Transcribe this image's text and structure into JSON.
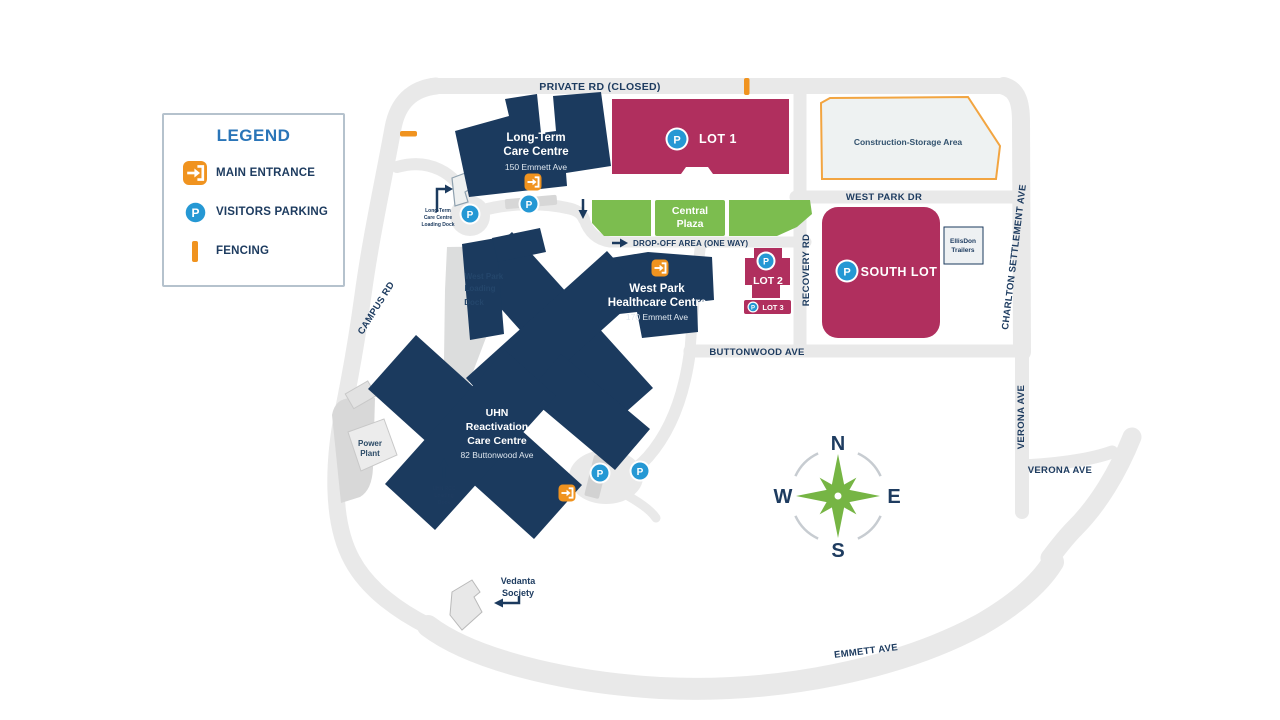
{
  "legend": {
    "title": "LEGEND",
    "items": [
      {
        "label": "MAIN ENTRANCE"
      },
      {
        "label": "VISITORS PARKING"
      },
      {
        "label": "FENCING"
      }
    ]
  },
  "icons": {
    "parking_letter": "P"
  },
  "compass": {
    "n": "N",
    "e": "E",
    "s": "S",
    "w": "W"
  },
  "roads": {
    "private_rd": "PRIVATE RD (CLOSED)",
    "campus_rd": "CAMPUS RD",
    "west_park_dr": "WEST PARK DR",
    "recovery_rd": "RECOVERY RD",
    "buttonwood_ave": "BUTTONWOOD AVE",
    "charlton_settlement_ave": "CHARLTON SETTLEMENT AVE",
    "verona_ave_vertical": "VERONA AVE",
    "verona_ave_horizontal": "VERONA AVE",
    "emmett_ave": "EMMETT AVE",
    "drop_off": "DROP-OFF  AREA (ONE WAY)"
  },
  "parking_lots": {
    "lot1": "LOT 1",
    "lot2": "LOT 2",
    "lot3": "LOT 3",
    "south_lot": "SOUTH LOT"
  },
  "buildings": {
    "ltc": {
      "line1": "Long-Term",
      "line2": "Care Centre",
      "address": "150 Emmett Ave"
    },
    "wphc": {
      "line1": "West Park",
      "line2": "Healthcare Centre",
      "address": "170 Emmett Ave"
    },
    "uhn": {
      "line1": "UHN",
      "line2": "Reactivation",
      "line3": "Care Centre",
      "address": "82 Buttonwood Ave"
    },
    "power_plant": {
      "line1": "Power",
      "line2": "Plant"
    },
    "vedanta": {
      "line1": "Vedanta",
      "line2": "Society"
    },
    "ellisdon": {
      "line1": "EllisDon",
      "line2": "Trailers"
    }
  },
  "areas": {
    "central_plaza": {
      "line1": "Central",
      "line2": "Plaza"
    },
    "construction": "Construction-Storage Area",
    "wp_loading_dock": {
      "line1": "West Park",
      "line2": "Loading",
      "line3": "Dock"
    },
    "ltc_loading_dock": {
      "line1": "Long-Term",
      "line2": "Care Centre",
      "line3": "Loading Dock"
    },
    "uhn_loading_dock": {
      "line1": "UHN RCC",
      "line2": "Loading",
      "line3": "Dock"
    }
  },
  "colors": {
    "building_navy": "#1b3a5e",
    "lot_magenta": "#b02f5e",
    "plaza_green": "#7cbd4f",
    "compass_green": "#76b544",
    "entrance_orange": "#f0931f",
    "parking_blue": "#2598d4",
    "road_gray": "#e9e9e9",
    "legend_blue": "#2a75b8"
  }
}
